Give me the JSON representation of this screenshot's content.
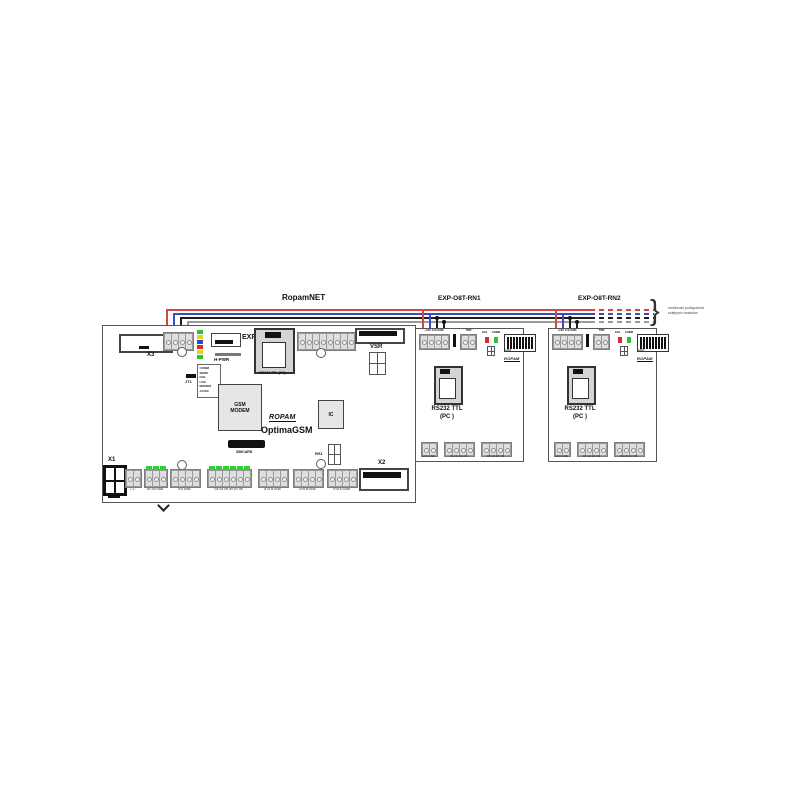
{
  "bus": {
    "label": "RopamNET",
    "note_line1": "możliwość podłączenia",
    "note_line2": "kolejnych modułów",
    "wire_colors": {
      "v12": "#d64545",
      "a": "#3d49c9",
      "b": "#1e1e1e",
      "gnd": "#9a9a9a"
    }
  },
  "mainboard": {
    "title": "OptimaGSM",
    "brand": "ROPAM",
    "x3": "X3",
    "exp": "EXP",
    "hpwr": "H-PWR",
    "jt1": "JT1",
    "rs232_label": "RS232 TTL (PC)",
    "pre_plusminus": "+ -",
    "pre": "PRE",
    "vsr": "VSR",
    "gsm_chip": "GSM\nMODEM",
    "ic_chip": "IC",
    "simcard": "SIMCARD",
    "rs1": "RS1",
    "x1": "X1",
    "x2": "X2",
    "led_colors": [
      "#2fc12f",
      "#ddd320",
      "#2b46d9",
      "#d92b2b",
      "#ddd320",
      "#2fc12f"
    ],
    "led_legend": [
      "COMM",
      "SEND",
      "FAIL",
      "LOG",
      "MODEM",
      "AC/DC"
    ],
    "terminals": [
      {
        "label": "+ V -"
      },
      {
        "label": "O1 O2 GND"
      },
      {
        "label": "IN1 GND"
      },
      {
        "label": "O3 O4 O5 O6 O7 O8"
      },
      {
        "label": "I1 I2 I3 GND"
      },
      {
        "label": "I4 I5 I6 GND"
      },
      {
        "label": "I7 I8 AI GND"
      }
    ]
  },
  "expanders": [
    {
      "title": "EXP-O8T-RN1",
      "bus_terms": "+12V A B GND",
      "tamper": "TMP",
      "led_fail": "FAIL",
      "led_comm": "COMM",
      "dip_label": "ADR",
      "brand": "ROPAM",
      "rs232_line1": "RS232 TTL",
      "rs232_line2": "(PC )",
      "bottom": [
        "AUX GND",
        "O1 O2 O3 O4",
        "O5 O6 O7 O8"
      ]
    },
    {
      "title": "EXP-O8T-RN2",
      "bus_terms": "+12V A B GND",
      "tamper": "TMP",
      "led_fail": "FAIL",
      "led_comm": "COMM",
      "dip_label": "ADR",
      "brand": "ROPAM",
      "rs232_line1": "RS232 TTL",
      "rs232_line2": "(PC )",
      "bottom": [
        "AUX GND",
        "O1 O2 O3 O4",
        "O5 O6 O7 O8"
      ]
    }
  ]
}
